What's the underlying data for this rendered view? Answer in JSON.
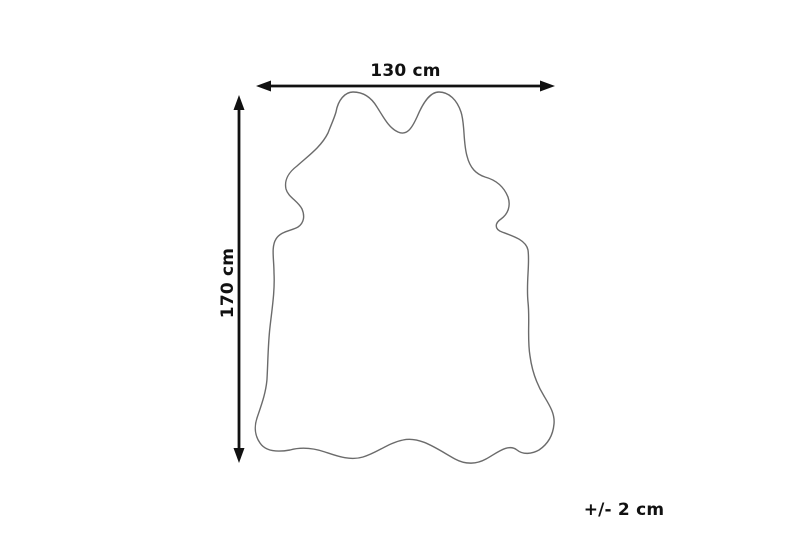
{
  "colors": {
    "background": "#ffffff",
    "outline": "#6b6b6b",
    "arrow": "#111111",
    "text": "#111111"
  },
  "diagram": {
    "type": "product-dimension-diagram",
    "subject": "cowhide-rug-outline",
    "width": {
      "label": "130 cm"
    },
    "height": {
      "label": "170 cm"
    },
    "tolerance": {
      "label": "+/- 2 cm"
    }
  }
}
